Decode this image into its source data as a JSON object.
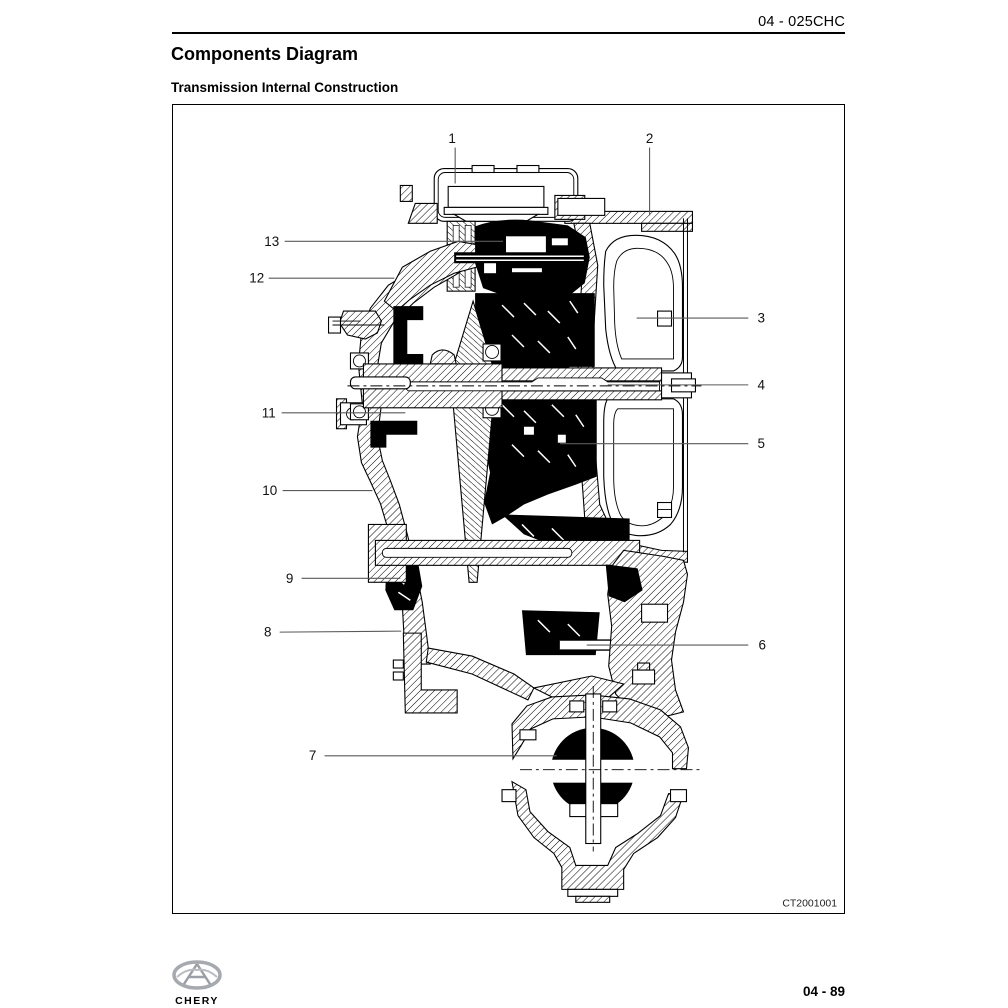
{
  "header": {
    "section_code": "04 - 025CHC"
  },
  "page": {
    "title": "Components Diagram",
    "subtitle": "Transmission Internal Construction"
  },
  "figure": {
    "code": "CT2001001",
    "callouts": [
      {
        "label": "1",
        "tx": 280,
        "ty": 33,
        "x1": 283,
        "y1": 42,
        "x2": 283,
        "y2": 78
      },
      {
        "label": "2",
        "tx": 478,
        "ty": 33,
        "x1": 478,
        "y1": 42,
        "x2": 478,
        "y2": 110
      },
      {
        "label": "3",
        "tx": 590,
        "ty": 213,
        "x1": 577,
        "y1": 213,
        "x2": 465,
        "y2": 213
      },
      {
        "label": "4",
        "tx": 590,
        "ty": 280,
        "x1": 577,
        "y1": 280,
        "x2": 436,
        "y2": 280
      },
      {
        "label": "5",
        "tx": 590,
        "ty": 339,
        "x1": 577,
        "y1": 339,
        "x2": 388,
        "y2": 339
      },
      {
        "label": "6",
        "tx": 591,
        "ty": 541,
        "x1": 577,
        "y1": 541,
        "x2": 415,
        "y2": 541
      },
      {
        "label": "7",
        "tx": 140,
        "ty": 652,
        "x1": 152,
        "y1": 652,
        "x2": 385,
        "y2": 652
      },
      {
        "label": "8",
        "tx": 95,
        "ty": 528,
        "x1": 107,
        "y1": 528,
        "x2": 229,
        "y2": 527
      },
      {
        "label": "9",
        "tx": 117,
        "ty": 474,
        "x1": 129,
        "y1": 474,
        "x2": 228,
        "y2": 474
      },
      {
        "label": "10",
        "tx": 97,
        "ty": 386,
        "x1": 110,
        "y1": 386,
        "x2": 200,
        "y2": 386
      },
      {
        "label": "11",
        "tx": 96,
        "ty": 308,
        "x1": 109,
        "y1": 308,
        "x2": 233,
        "y2": 308
      },
      {
        "label": "12",
        "tx": 84,
        "ty": 173,
        "x1": 96,
        "y1": 173,
        "x2": 222,
        "y2": 173
      },
      {
        "label": "13",
        "tx": 99,
        "ty": 136,
        "x1": 112,
        "y1": 136,
        "x2": 331,
        "y2": 136
      }
    ]
  },
  "footer": {
    "brand": "CHERY",
    "page_number": "04 - 89"
  },
  "colors": {
    "ink": "#000000",
    "leader_line": "#5a5a5a",
    "brand_red": "#cc2129",
    "logo_gray": "#a6aaae"
  }
}
